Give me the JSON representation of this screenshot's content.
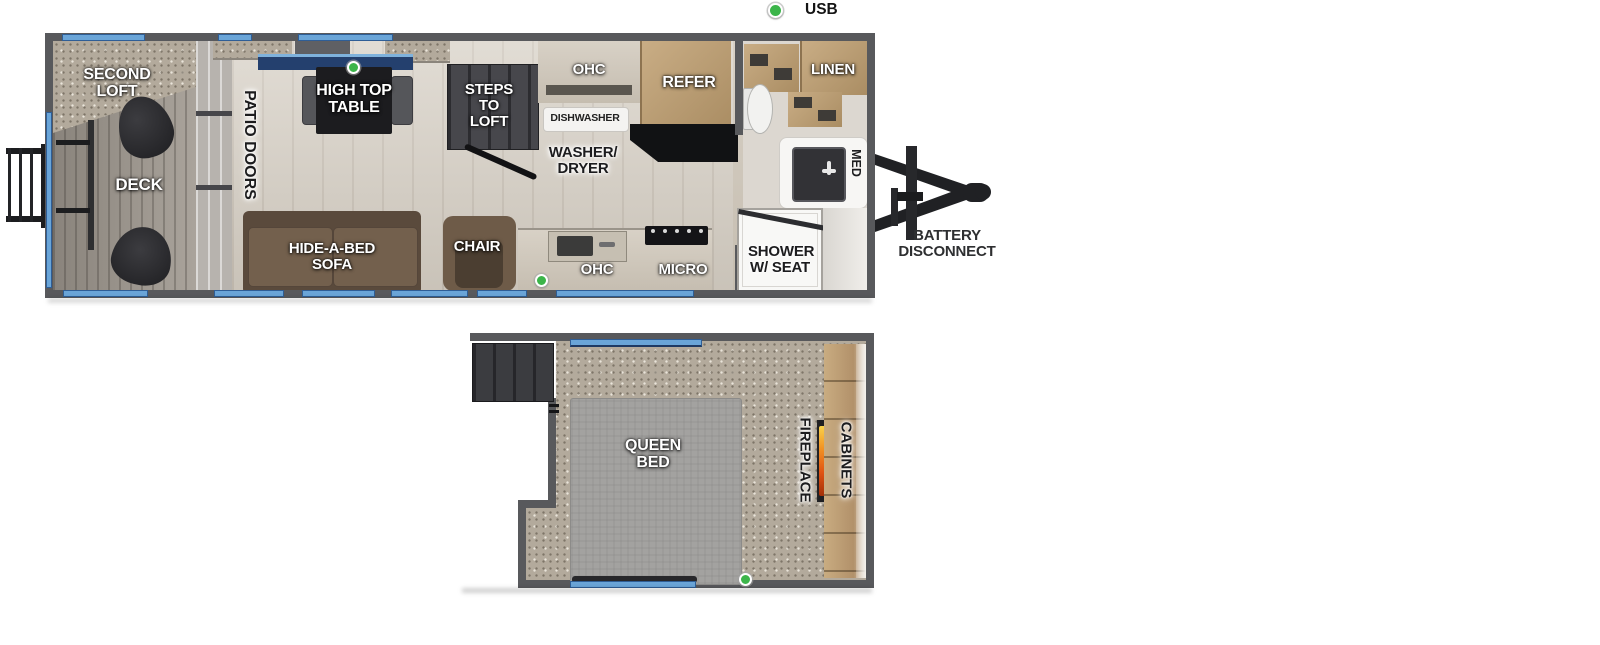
{
  "legend": {
    "usb_label": "USB"
  },
  "main": {
    "second_loft": "SECOND LOFT",
    "deck": "DECK",
    "patio_doors": "PATIO DOORS",
    "high_top_table": "HIGH TOP TABLE",
    "steps_to_loft": "STEPS TO LOFT",
    "ohc_top": "OHC",
    "dishwasher": "DISHWASHER",
    "washer_dryer": "WASHER/ DRYER",
    "refer": "REFER",
    "linen": "LINEN",
    "med": "MED",
    "shower_w_seat": "SHOWER W/ SEAT",
    "hide_a_bed_sofa": "HIDE-A-BED SOFA",
    "chair": "CHAIR",
    "ohc_bottom": "OHC",
    "micro": "MICRO",
    "battery_disconnect": "BATTERY DISCONNECT"
  },
  "loft": {
    "queen_bed": "QUEEN BED",
    "fireplace": "FIREPLACE",
    "cabinets": "CABINETS"
  },
  "colors": {
    "usb_green": "#3cb54a",
    "window_blue": "#6aa5d8",
    "wall_gray": "#58595c"
  }
}
